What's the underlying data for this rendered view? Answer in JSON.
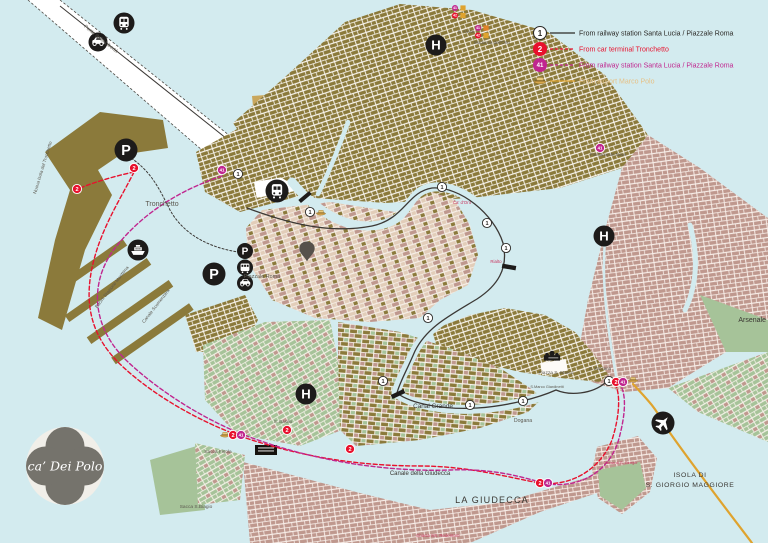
{
  "logo": {
    "text": "ca’ Dei Polo"
  },
  "colors": {
    "water": "#d3ebef",
    "olive": "#8b7a3b",
    "tan": "#c9a75d",
    "rose": "#bf988e",
    "green": "#a6c399",
    "cream": "#f6efe7",
    "routeBlack": "#3b3835",
    "routeRed": "#e8112d",
    "routeMagenta": "#c0268f",
    "routeGold": "#dfa32e",
    "labelGray": "#5b574e",
    "labelDark": "#3a3732",
    "labelRed": "#c9355f",
    "iconBlack": "#1d1b1a",
    "pinGray": "#56514b",
    "logoGray": "#75736c",
    "logoBg": "#f1efe9"
  },
  "legend": {
    "items": [
      {
        "badge": "1",
        "badge_fill": "#ffffff",
        "badge_stroke": "#2b2926",
        "badge_text": "#2b2926",
        "line": "#2b2926",
        "dashed": false,
        "label": "From railway station Santa Lucia / Piazzale Roma",
        "label_color": "#2b2926"
      },
      {
        "badge": "2",
        "badge_fill": "#e8112d",
        "badge_stroke": "#e8112d",
        "badge_text": "#ffffff",
        "line": "#e8112d",
        "dashed": true,
        "label": "From car terminal Tronchetto",
        "label_color": "#e8112d"
      },
      {
        "badge": "41",
        "badge_fill": "#c0268f",
        "badge_stroke": "#c0268f",
        "badge_text": "#ffffff",
        "line": "#c0268f",
        "dashed": true,
        "label": "From railway station Santa Lucia / Piazzale Roma",
        "label_color": "#c0268f"
      },
      {
        "badge": "boat",
        "badge_fill": "#dfa32e",
        "badge_stroke": "#dfa32e",
        "badge_text": "#ffffff",
        "line": "#dfa32e",
        "dashed": false,
        "label": "From airport Marco Polo",
        "label_color": "#e6c186"
      }
    ]
  },
  "map": {
    "labels": [
      {
        "n": "ponte-della-liberta",
        "t": "Ponte della Libertà",
        "x": 100,
        "y": 40,
        "s": 5,
        "c": "labelGray",
        "rot": 38.5
      },
      {
        "n": "nuova-isola-del-tronchetto",
        "t": "Nuova Isola del Tronchetto",
        "x": 44,
        "y": 168,
        "s": 4.6,
        "c": "labelGray",
        "rot": -73
      },
      {
        "n": "tronchetto",
        "t": "Tronchetto",
        "x": 162,
        "y": 206,
        "s": 7,
        "c": "labelGray"
      },
      {
        "n": "bacini-stazione-marittima",
        "t": "Bacini  Stazione  Marittima",
        "x": 113,
        "y": 288,
        "s": 4.6,
        "c": "labelGray",
        "rot": -52
      },
      {
        "n": "canale-scomenzera",
        "t": "Canale Scomenzera",
        "x": 157,
        "y": 307,
        "s": 4.6,
        "c": "labelGray",
        "rot": -52
      },
      {
        "n": "piazzale-roma",
        "t": "Piazzale Roma",
        "x": 262,
        "y": 278,
        "s": 5.4,
        "c": "labelGray"
      },
      {
        "n": "canal-grande",
        "t": "Canal  Grande",
        "x": 433,
        "y": 408,
        "s": 6.4,
        "c": "labelDark"
      },
      {
        "n": "canale-della-giudecca",
        "t": "Canale della Giudecca",
        "x": 420,
        "y": 475,
        "s": 6,
        "c": "labelDark"
      },
      {
        "n": "la-giudecca",
        "t": "LA GIUDECCA",
        "x": 492,
        "y": 503,
        "s": 9,
        "c": "labelDark",
        "ls": 1.2
      },
      {
        "n": "isola-di",
        "t": "ISOLA DI",
        "x": 690,
        "y": 477,
        "s": 6.8,
        "c": "labelDark",
        "ls": 0.6
      },
      {
        "n": "s-giorgio-maggiore",
        "t": "S. GIORGIO MAGGIORE",
        "x": 690,
        "y": 487,
        "s": 6.8,
        "c": "labelDark",
        "ls": 0.6
      },
      {
        "n": "dogana",
        "t": "Dogana",
        "x": 523,
        "y": 422,
        "s": 5.2,
        "c": "labelGray"
      },
      {
        "n": "arsenale",
        "t": "Arsenale",
        "x": 766,
        "y": 322,
        "s": 7,
        "c": "labelDark",
        "a": "end"
      },
      {
        "n": "s-alvise",
        "t": "S. Alvise",
        "x": 466,
        "y": 33,
        "s": 4.4,
        "c": "labelGray"
      },
      {
        "n": "madonna-dell-orto",
        "t": "Madonna dell'Orto",
        "x": 492,
        "y": 44,
        "s": 4.4,
        "c": "labelGray"
      },
      {
        "n": "fondamente-nove",
        "t": "Fondamente Nove",
        "x": 608,
        "y": 156,
        "s": 4.4,
        "c": "labelGray"
      },
      {
        "n": "s-zaccaria",
        "t": "S. Zaccaria",
        "x": 600,
        "y": 370,
        "s": 4.4,
        "c": "labelGray"
      },
      {
        "n": "piazza-s-marco",
        "t": "Piazza S. Marco",
        "x": 556,
        "y": 374,
        "s": 4.8,
        "c": "labelGray"
      },
      {
        "n": "s-marco-giardinetti",
        "t": "S.Marco Giardinetti",
        "x": 547,
        "y": 388,
        "s": 3.9,
        "c": "labelGray"
      },
      {
        "n": "sacca-fisola",
        "t": "Sacca Fisola",
        "x": 218,
        "y": 453,
        "s": 4.8,
        "c": "labelGray"
      },
      {
        "n": "sacca-s-biagio",
        "t": "Sacca S.Biagio",
        "x": 196,
        "y": 508,
        "s": 4.8,
        "c": "labelGray"
      },
      {
        "n": "s-basilio",
        "t": "S. Basilio",
        "x": 283,
        "y": 423,
        "s": 4.4,
        "c": "labelGray"
      },
      {
        "n": "ca-d-oro",
        "t": "Ca' d'Oro",
        "x": 462,
        "y": 204,
        "s": 4.4,
        "c": "labelRed"
      },
      {
        "n": "rialto",
        "t": "Rialto",
        "x": 496,
        "y": 263,
        "s": 4.4,
        "c": "labelRed"
      },
      {
        "n": "chiesa-ss-redentore",
        "t": "Chiesa SS. Redentore",
        "x": 438,
        "y": 537,
        "s": 4.4,
        "c": "labelRed"
      },
      {
        "n": "chiesa-s-giorgio",
        "t": "Chiesa di S. Giorgio",
        "x": 620,
        "y": 464,
        "s": 3.9,
        "c": "labelRed"
      }
    ],
    "stops": {
      "route1": {
        "name": "vaporetto-stop-line1",
        "label": "1",
        "fill": "#ffffff",
        "stroke": "#2b2926",
        "text_color": "#2b2926",
        "r": 4.6,
        "fs": 5.6,
        "points": [
          [
            238,
            174
          ],
          [
            310,
            212
          ],
          [
            442,
            187
          ],
          [
            487,
            223
          ],
          [
            506,
            248
          ],
          [
            428,
            318
          ],
          [
            383,
            381
          ],
          [
            470,
            405
          ],
          [
            523,
            401
          ],
          [
            609,
            381
          ]
        ]
      },
      "route2": {
        "name": "vaporetto-stop-line2",
        "label": "2",
        "fill": "#e8112d",
        "stroke": "#ffffff",
        "text_color": "#ffffff",
        "r": 4.6,
        "fs": 5.6,
        "points": [
          [
            134,
            168
          ],
          [
            77,
            189
          ],
          [
            233,
            435
          ],
          [
            287,
            430
          ],
          [
            350,
            449
          ],
          [
            540,
            483
          ],
          [
            616,
            382
          ]
        ]
      },
      "route41": {
        "name": "vaporetto-stop-line41",
        "label": "41",
        "fill": "#c0268f",
        "stroke": "#ffffff",
        "text_color": "#ffffff",
        "r": 4.6,
        "fs": 4.4,
        "points": [
          [
            222,
            170
          ],
          [
            241,
            435
          ],
          [
            548,
            483
          ],
          [
            623,
            382
          ],
          [
            600,
            148
          ]
        ]
      }
    },
    "icons": [
      {
        "n": "train-bridge-icon",
        "sym": "train",
        "x": 124,
        "y": 23,
        "r": 10.5
      },
      {
        "n": "car-bridge-icon",
        "sym": "car",
        "x": 98,
        "y": 42,
        "r": 9.5
      },
      {
        "n": "parking-tronchetto-icon",
        "sym": "P",
        "x": 126,
        "y": 150,
        "r": 11.5
      },
      {
        "n": "car-ferry-icon",
        "sym": "ship",
        "x": 138,
        "y": 250,
        "r": 10.5
      },
      {
        "n": "train-station-icon",
        "sym": "train",
        "x": 277,
        "y": 191,
        "r": 11.5
      },
      {
        "n": "parking-garage-icon",
        "sym": "P",
        "x": 214,
        "y": 274,
        "r": 11.5
      },
      {
        "n": "parking-piazzale-roma-icon",
        "sym": "P",
        "x": 245,
        "y": 251,
        "r": 8
      },
      {
        "n": "bus-terminal-icon",
        "sym": "bus",
        "x": 245,
        "y": 267.5,
        "r": 8
      },
      {
        "n": "car-terminal-icon",
        "sym": "car",
        "x": 245,
        "y": 283,
        "r": 8
      },
      {
        "n": "hotel-location-pin",
        "sym": "pin",
        "x": 307,
        "y": 252,
        "r": 11
      },
      {
        "n": "hospital-icon-cannaregio",
        "sym": "H",
        "x": 436,
        "y": 45,
        "r": 10.5
      },
      {
        "n": "hospital-icon-castello",
        "sym": "H",
        "x": 604,
        "y": 236,
        "r": 10.5
      },
      {
        "n": "hospital-icon-dorsoduro",
        "sym": "H",
        "x": 306,
        "y": 394,
        "r": 10.5
      },
      {
        "n": "airport-plane-icon",
        "sym": "plane",
        "x": 663,
        "y": 423,
        "r": 11.5
      },
      {
        "n": "basilica-san-marco-icon",
        "sym": "basilica",
        "x": 552,
        "y": 357,
        "r": 9
      },
      {
        "n": "alilaguna-boat-icon",
        "sym": "boat",
        "x": 321,
        "y": 213,
        "r": 6
      },
      {
        "n": "alilaguna-boat-icon",
        "sym": "boat",
        "x": 633,
        "y": 380,
        "r": 6
      },
      {
        "n": "alilaguna-boat-icon",
        "sym": "boat",
        "x": 225,
        "y": 435,
        "r": 6
      }
    ],
    "clusters": [
      {
        "n": "vaporetto-stops-s-alvise",
        "x": 455,
        "y": 8,
        "badges": [
          {
            "t": "41",
            "c": "#c0268f"
          },
          {
            "t": "",
            "c": "#dfa32e",
            "sq": true
          },
          {
            "t": "42",
            "c": "#e8112d"
          },
          {
            "t": "",
            "c": "#dfa32e",
            "sq": true
          }
        ]
      },
      {
        "n": "vaporetto-stops-madonna-dell-orto",
        "x": 478,
        "y": 28,
        "badges": [
          {
            "t": "41",
            "c": "#c0268f"
          },
          {
            "t": "",
            "c": "#e08428",
            "sq": true
          },
          {
            "t": "42",
            "c": "#e8112d"
          },
          {
            "t": "",
            "c": "#dfa32e",
            "sq": true
          }
        ]
      }
    ]
  }
}
